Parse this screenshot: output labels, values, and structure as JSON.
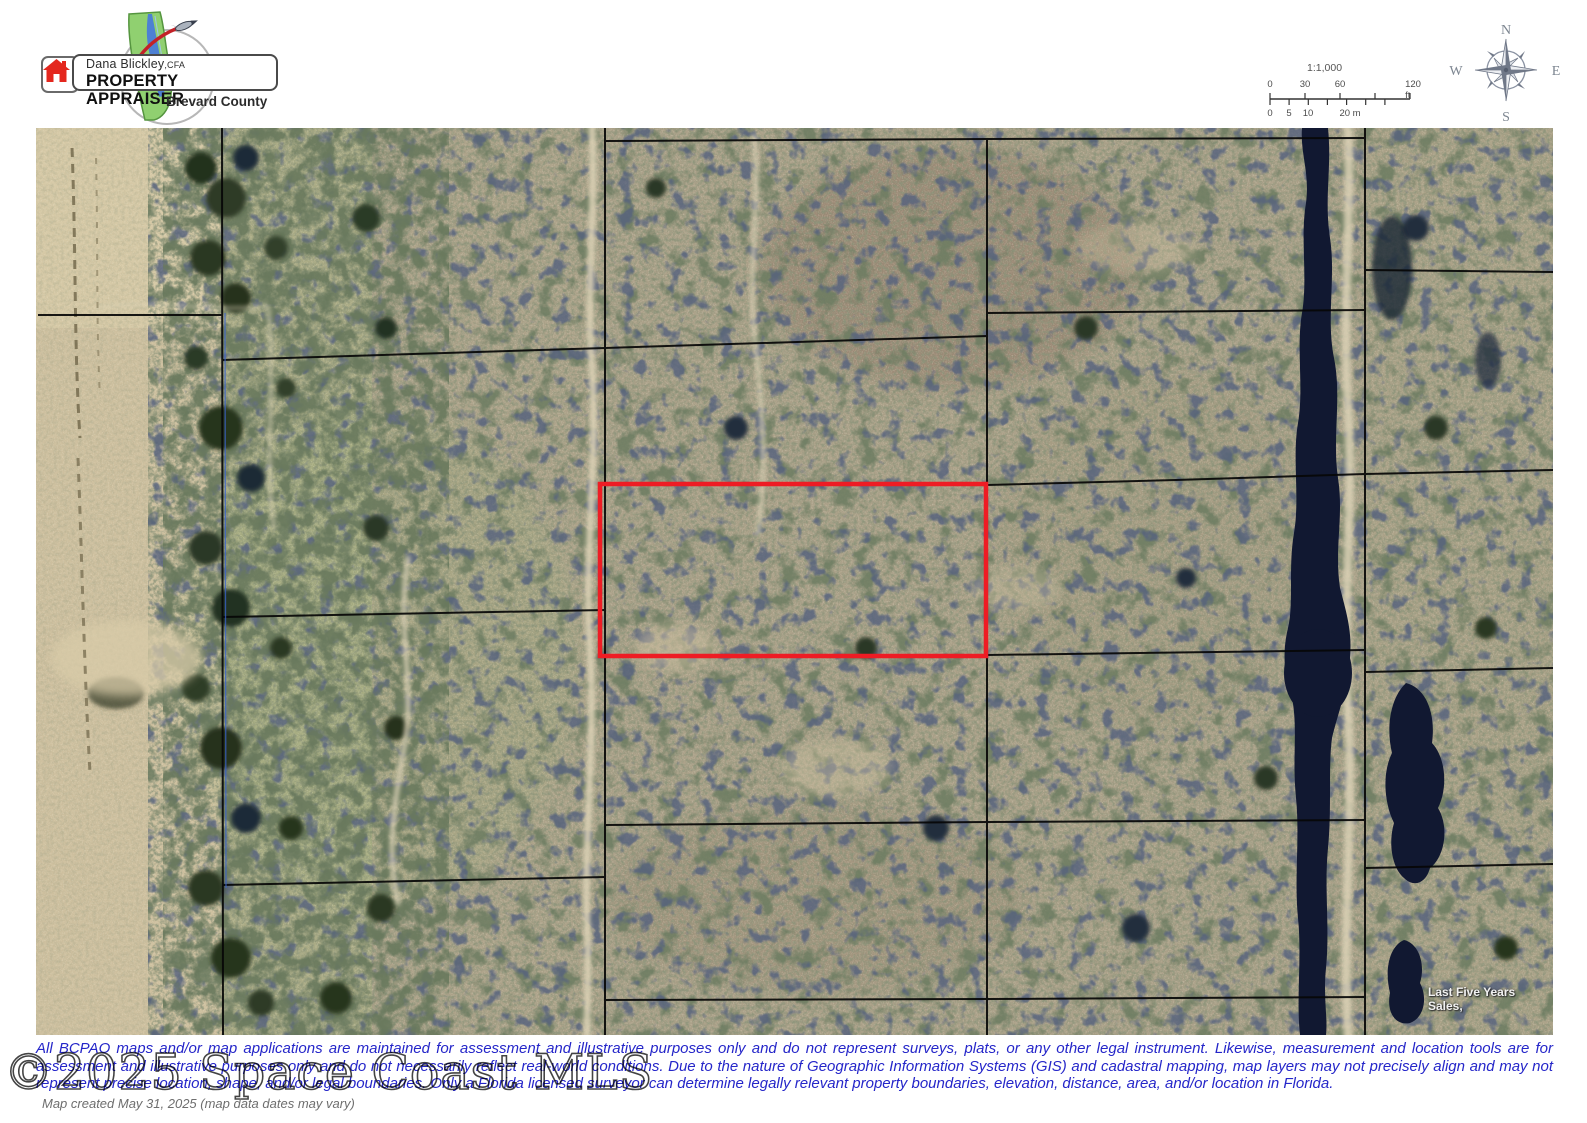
{
  "logo": {
    "name": "Dana Blickley",
    "designation": ",CFA",
    "title": "PROPERTY APPRAISER",
    "county": "Brevard County"
  },
  "scalebar": {
    "ratio": "1:1,000",
    "ft_labels": [
      "0",
      "30",
      "60",
      "120 ft"
    ],
    "m_labels": [
      "0",
      "5",
      "10",
      "20 m"
    ]
  },
  "compass": {
    "n": "N",
    "e": "E",
    "s": "S",
    "w": "W"
  },
  "map": {
    "sales_label": "Last Five Years Sales,",
    "highlight_color": "#ee1c24"
  },
  "disclaimer": {
    "text": "All BCPAO maps and/or map applications are maintained for assessment and illustrative purposes only and do not represent surveys, plats, or any other legal instrument. Likewise, measurement and location tools are for assessment and illustrative purposes only and do not necessarily reflect real-world conditions. Due to the nature of Geographic Information Systems (GIS) and cadastral mapping, map layers may not precisely align and may not represent precise location, shape, and/or legal boundaries. Only a Florida licensed surveyor can determine legally relevant property boundaries, elevation, distance, area, and/or location in Florida."
  },
  "watermark": {
    "text": "©2025 Space Coast MLS"
  },
  "footer": {
    "created": "Map created May 31, 2025 (map data dates may vary)"
  }
}
